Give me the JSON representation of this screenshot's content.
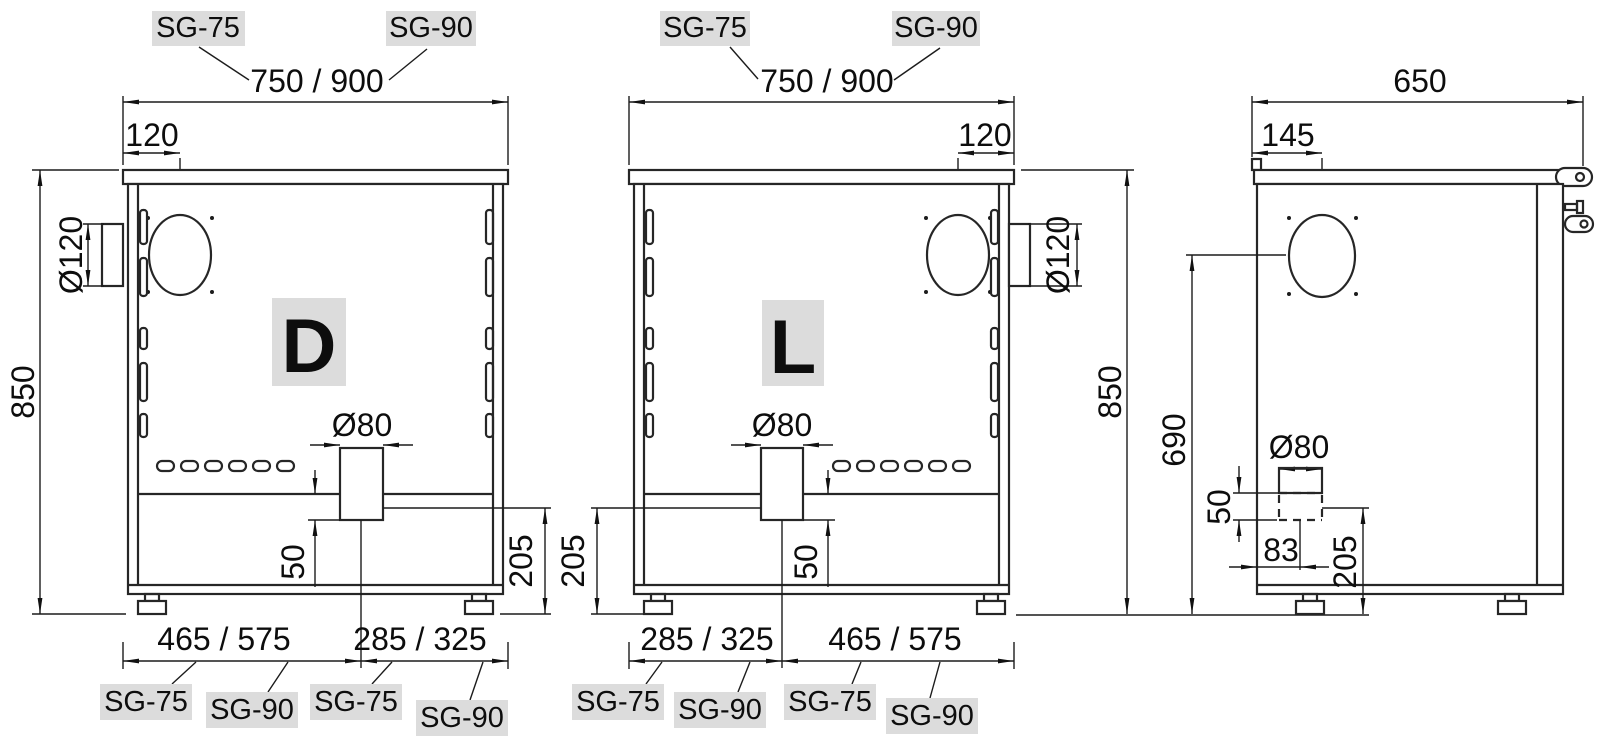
{
  "front_d": {
    "badge": "D",
    "model_left": "SG-75",
    "model_right": "SG-90",
    "width": "750 / 900",
    "flue_offset": "120",
    "flue_diameter": "Ø120",
    "height": "850",
    "duct_diameter": "Ø80",
    "duct_drop": "50",
    "outlet_height": "205",
    "bottom_left": "465 / 575",
    "bottom_right": "285 / 325",
    "bottom_labels": [
      "SG-75",
      "SG-90",
      "SG-75",
      "SG-90"
    ]
  },
  "front_l": {
    "badge": "L",
    "model_left": "SG-75",
    "model_right": "SG-90",
    "width": "750 / 900",
    "flue_offset": "120",
    "flue_diameter": "Ø120",
    "height": "850",
    "duct_diameter": "Ø80",
    "duct_drop": "50",
    "outlet_height": "205",
    "bottom_left": "285 / 325",
    "bottom_right": "465 / 575",
    "bottom_labels": [
      "SG-75",
      "SG-90",
      "SG-75",
      "SG-90"
    ]
  },
  "side": {
    "depth": "650",
    "hole_offset": "145",
    "hole_height": "690",
    "duct_diameter": "Ø80",
    "duct_drop": "50",
    "duct_center_offset": "83",
    "outlet_height": "205"
  }
}
